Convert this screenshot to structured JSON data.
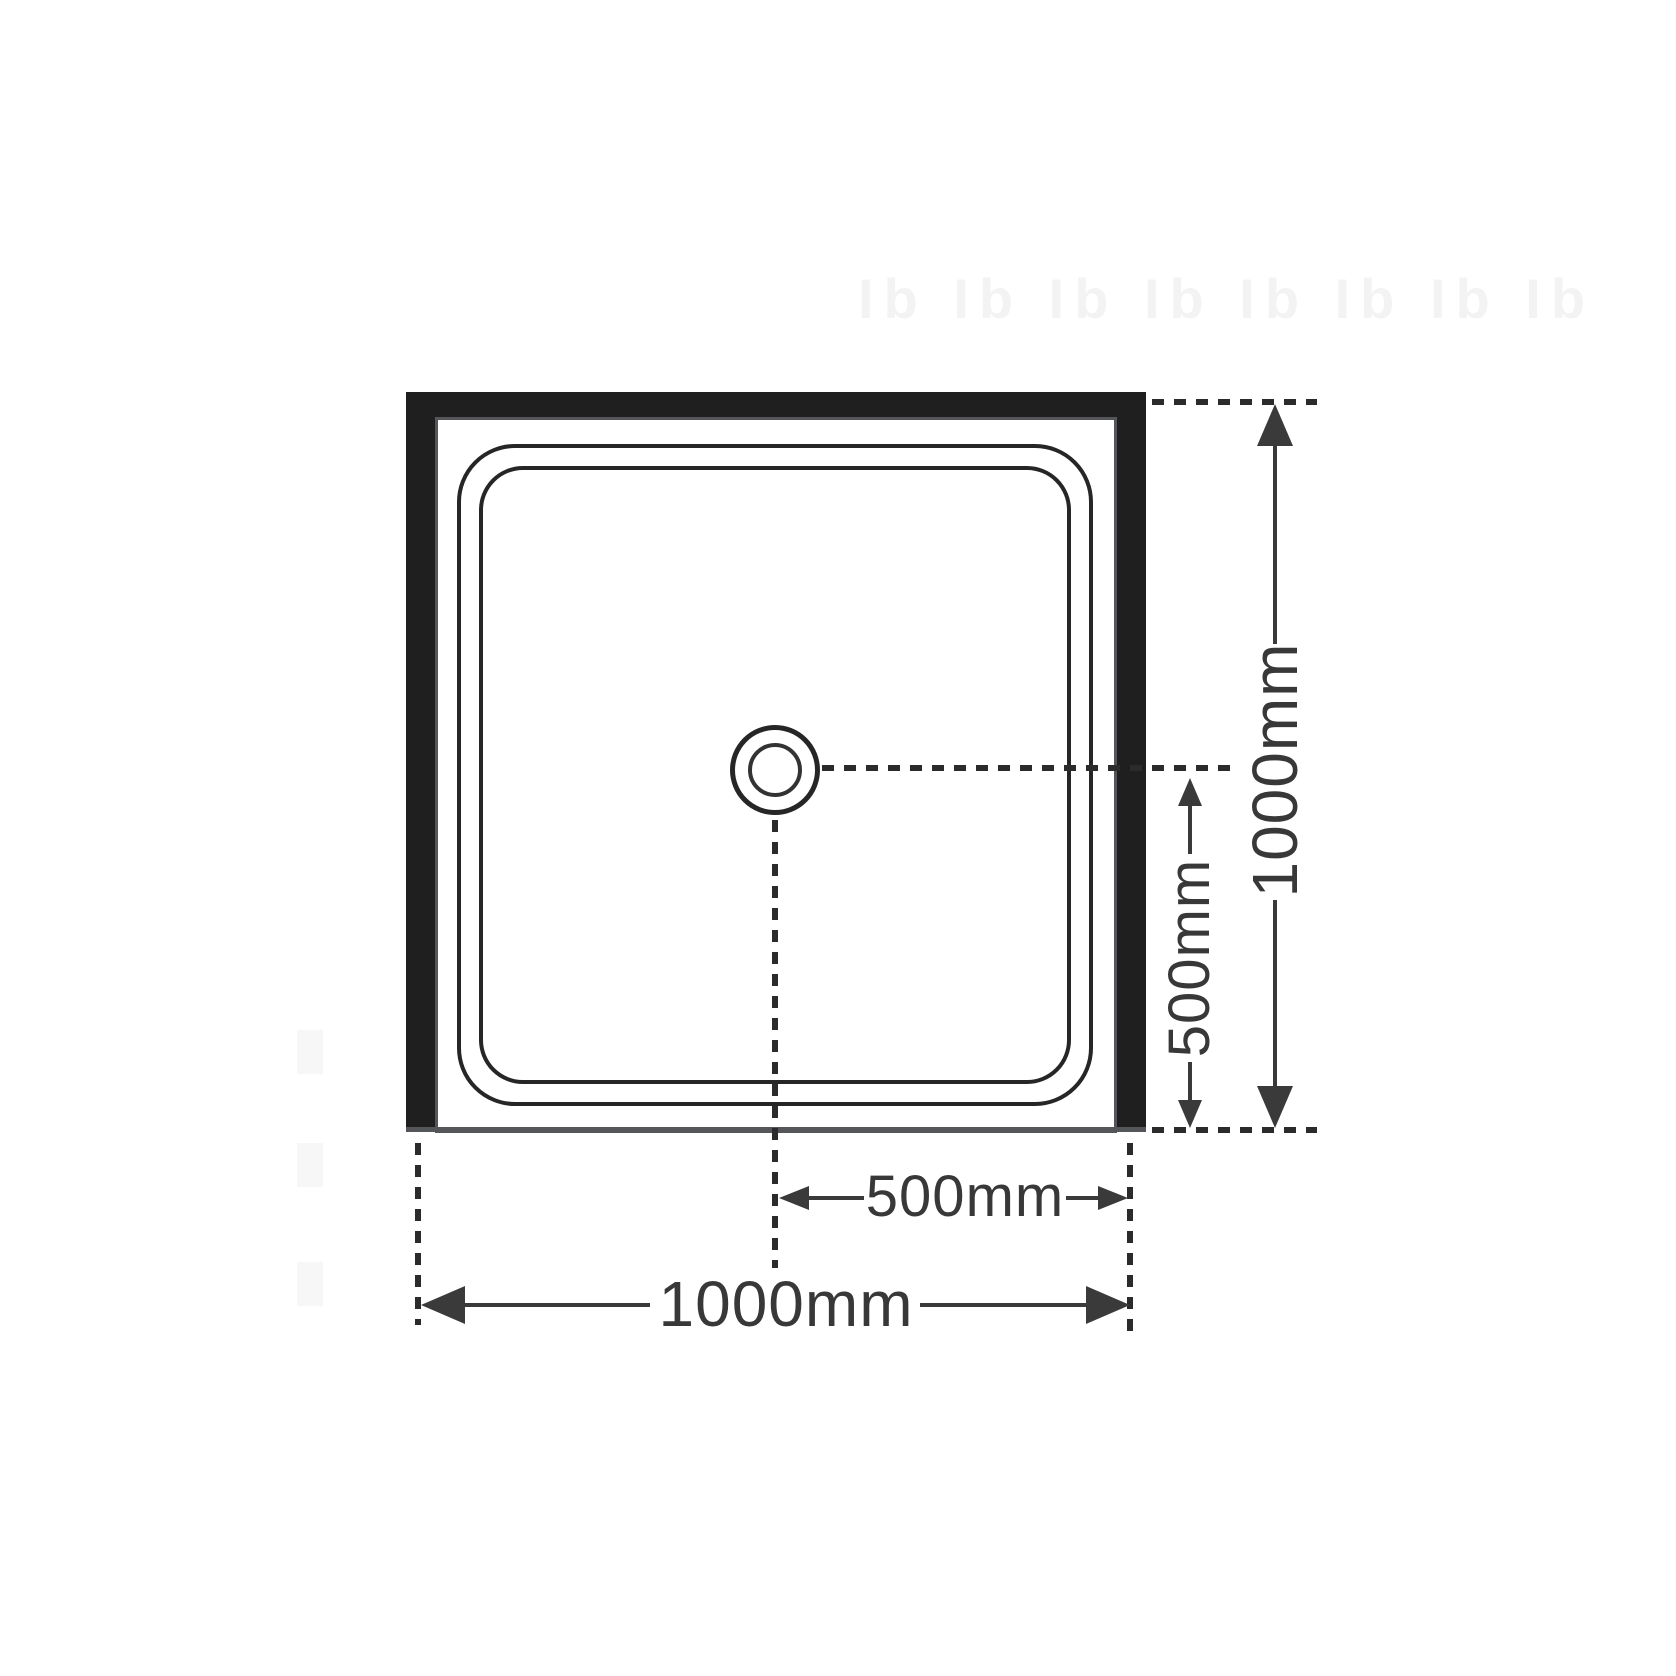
{
  "diagram": {
    "labels": {
      "overall_height": "1000mm",
      "overall_width": "1000mm",
      "drain_offset_height": "500mm",
      "drain_offset_width": "500mm"
    },
    "watermark": {
      "top_text": "Ib Ib Ib Ib Ib Ib Ib Ib"
    },
    "colors": {
      "wall_fill": "#1f1f1f",
      "tray_edge_line": "#55565a",
      "lip_line": "#262626",
      "dash_line": "#2b2b2b",
      "dimension_line": "#3a3a3a",
      "watermark": "#f3f3f3",
      "background": "#ffffff"
    }
  }
}
